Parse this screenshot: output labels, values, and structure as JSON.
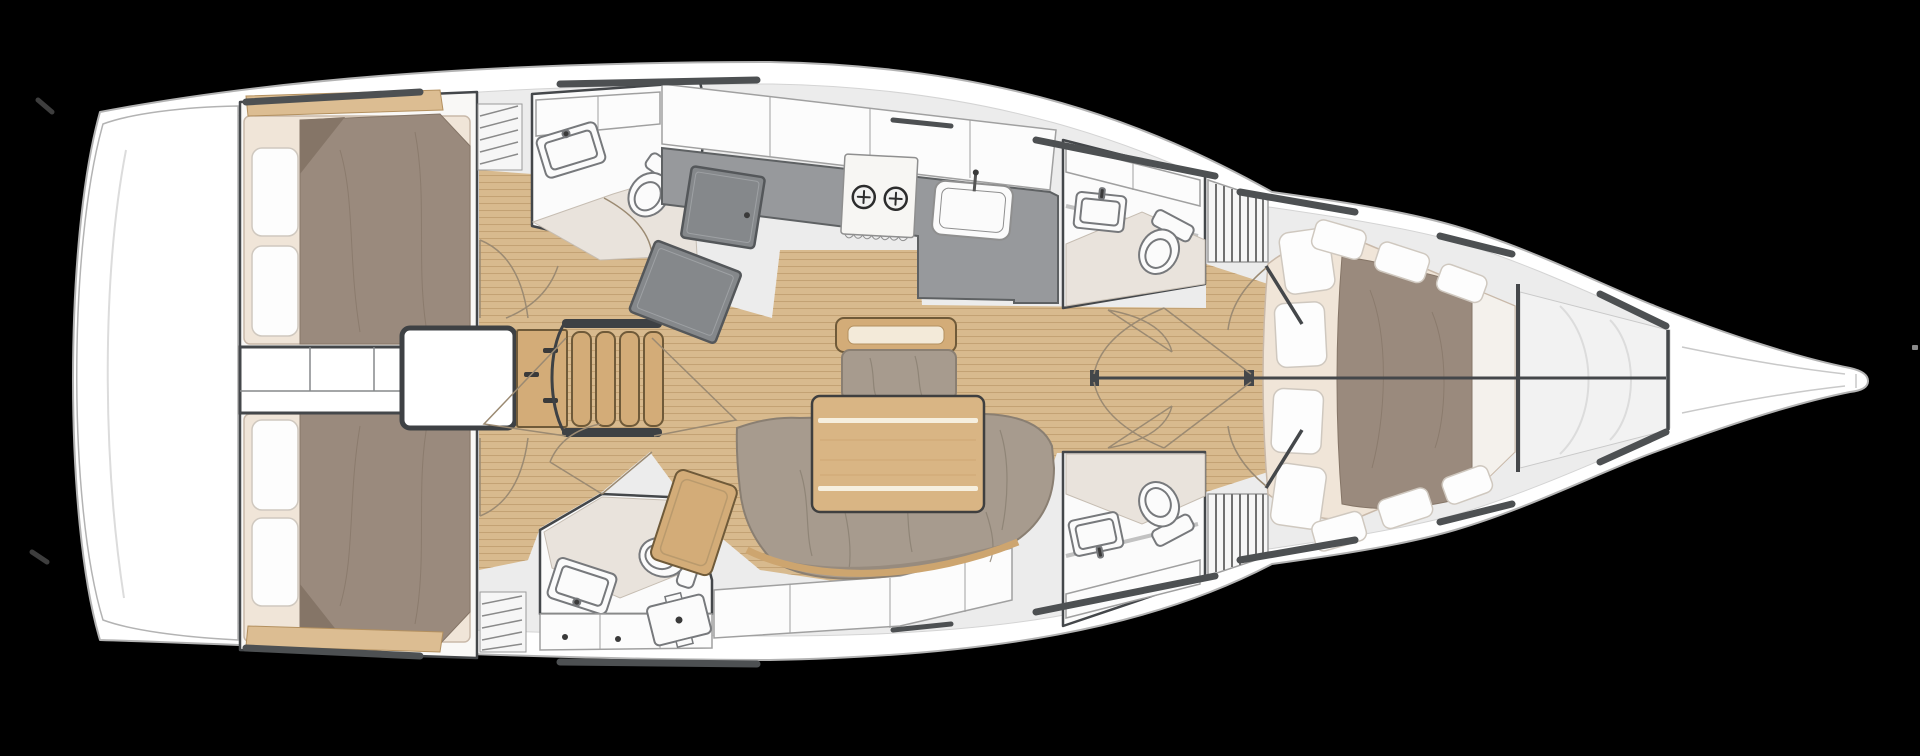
{
  "scene": {
    "type": "yacht-interior-floor-plan",
    "view": "top-down",
    "bow_direction": "right",
    "background": "#000000"
  },
  "colors": {
    "bg": "#000000",
    "hull": "#ffffff",
    "hullStroke": "#b3b3b3",
    "deck": "#ececec",
    "deckStroke": "#d4d4d4",
    "rail": "#4d5052",
    "wall": "#44474a",
    "wood": "#d8ba8e",
    "woodLine": "#c3a274",
    "trimWood": "#dcbd92",
    "trimWoodStroke": "#b3905f",
    "furnWood": "#d3ac78",
    "furnWoodStroke": "#6f5a39",
    "tableWood": "#d9b584",
    "tableStripe": "#f6efdf",
    "counter": "#97999c",
    "counterStroke": "#5e6163",
    "appliance": "#85888b",
    "applianceStroke": "#54575a",
    "applianceInner": "#9ea1a4",
    "duvet": "#9a8a7d",
    "duvetShade": "#857567",
    "mattress": "#f0e5d8",
    "mattressStroke": "#c9b9a9",
    "pillow": "#fdfdfd",
    "pillowStroke": "#cfc8bf",
    "cushion": "#a79b8e",
    "cushionSeam": "#8a7f72",
    "bath": "#e9e3dc",
    "bathStroke": "#c6bdb2",
    "fixture": "#fbfbfb",
    "fixtureStroke": "#77797c",
    "locker": "#fcfcfc",
    "lockerStroke": "#a0a0a0",
    "arc": "#9b8a72",
    "slat": "#8a8a8a",
    "dot": "#3a3a3a"
  },
  "features": {
    "aft_double_cabins": 2,
    "aft_heads": 2,
    "forward_heads": 2,
    "forward_v_berth_cabins": 1,
    "companionway_steps": 4,
    "galley_burners": 2,
    "galley_sinks": 1,
    "head_sinks": 4,
    "toilets": 4,
    "salon": {
      "tables": 1,
      "sofas": 1,
      "settee_benches": 1,
      "chaise_seats": 1
    },
    "pillows": {
      "per_aft_cabin": 2,
      "forward_cabin": 4
    }
  }
}
